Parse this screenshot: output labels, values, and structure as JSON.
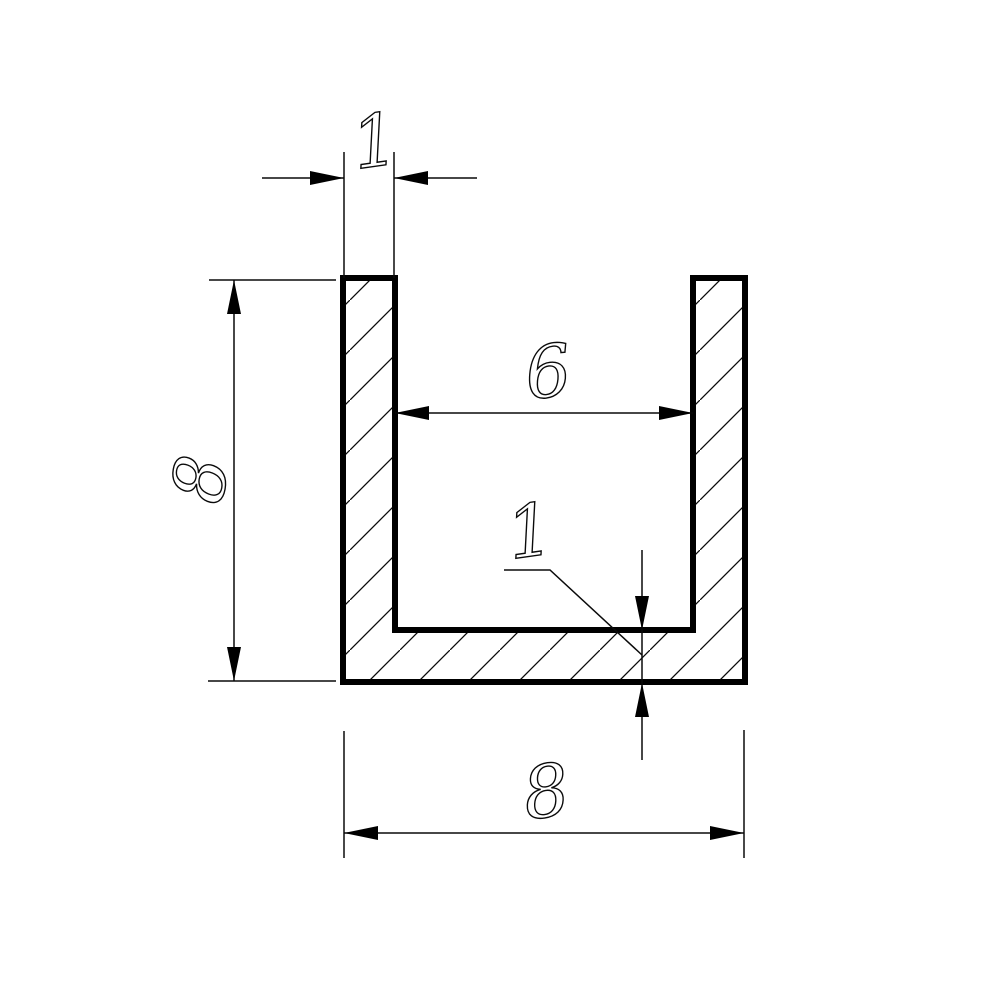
{
  "drawing": {
    "background_color": "#ffffff",
    "line_color": "#000000",
    "profile": {
      "kind": "u-channel-cross-section",
      "hatch": "diagonal-45deg"
    },
    "dimensions": {
      "flange_thickness": {
        "value": "1"
      },
      "height": {
        "value": "8"
      },
      "inner_width": {
        "value": "6"
      },
      "web_thickness": {
        "value": "1"
      },
      "outer_width": {
        "value": "8"
      }
    }
  }
}
